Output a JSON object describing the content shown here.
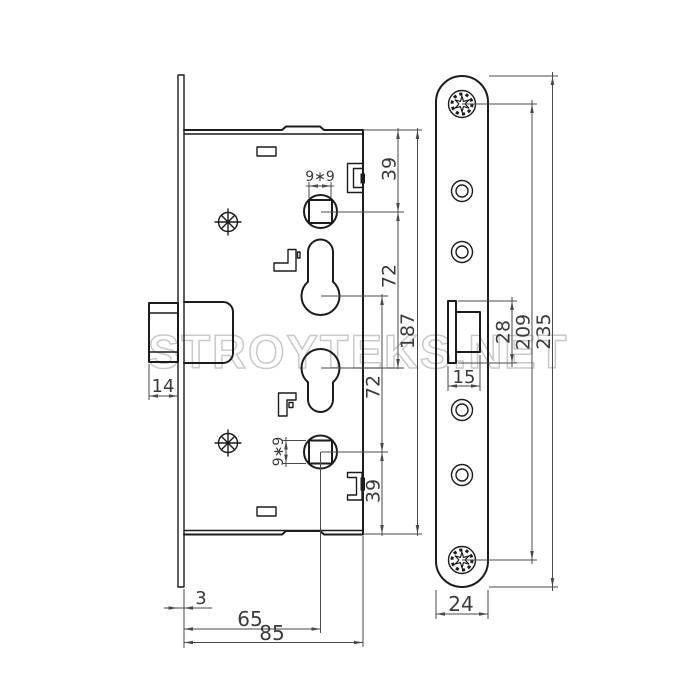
{
  "watermark": "STROYTEKS.NET",
  "colors": {
    "line": "#1c1c1c",
    "dim": "#4a4a4a",
    "dimtext": "#3a3a3a",
    "wm": "#c9c9c9",
    "bg": "#ffffff"
  },
  "dims": {
    "case_top_to_spindle": "39",
    "spindle_to_cylinder": "72",
    "case_height": "187",
    "cylinder_to_spindle_lower": "72",
    "spindle_to_case_bottom": "39",
    "spindle_square_top": "9∗9",
    "spindle_square_bottom": "9∗9",
    "latch_projection": "14",
    "faceplate_thickness": "3",
    "backset": "65",
    "case_depth": "85",
    "latch_cutout_width": "15",
    "latch_cutout_height": "28",
    "screw_hole_spacing": "209",
    "faceplate_length": "235",
    "faceplate_width": "24"
  }
}
